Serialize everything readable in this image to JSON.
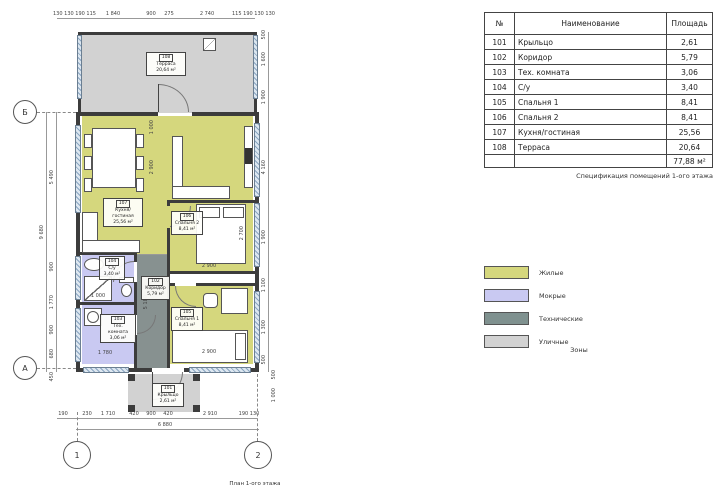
{
  "colors": {
    "living": "#d5d77d",
    "wet": "#c9c9f2",
    "technical": "#7f918f",
    "street": "#d2d2d2",
    "wall": "#3c3c3c"
  },
  "plan": {
    "caption": "План 1-ого этажа",
    "axes": {
      "b": "Б",
      "a": "А",
      "one": "1",
      "two": "2"
    },
    "rooms": {
      "porch": {
        "num": "101",
        "name": "Крыльцо",
        "area": "2,61 м²"
      },
      "corridor": {
        "num": "102",
        "name": "Коридор",
        "area": "5,79 м²"
      },
      "tech": {
        "num": "103",
        "name": "Тех. комната",
        "area": "3,06 м²"
      },
      "wc": {
        "num": "104",
        "name": "С/у",
        "area": "3,40 м²"
      },
      "bedroom1": {
        "num": "105",
        "name": "Спальня 1",
        "area": "8,41 м²"
      },
      "bedroom2": {
        "num": "106",
        "name": "Спальня 2",
        "area": "8,41 м²"
      },
      "kitchen": {
        "num": "107",
        "name": "Кухня/гостиная",
        "area": "25,56 м²"
      },
      "terrace": {
        "num": "108",
        "name": "Терраса",
        "area": "20,64 м²"
      }
    },
    "dims": {
      "top": [
        "130 130 190 115",
        "1 840",
        "900",
        "275",
        "2 740",
        "115 190 130 130"
      ],
      "left": {
        "total": "9 680",
        "chain": [
          "5 490",
          "900",
          "1 770",
          "900",
          "680"
        ],
        "below": "450"
      },
      "right": [
        "500",
        "1 600",
        "1 900",
        "4 160",
        "1 900",
        "1 100",
        "1 300",
        "500"
      ],
      "right_extra": [
        "500",
        "1 000"
      ],
      "bottom": [
        "190",
        "230",
        "1 710",
        "420",
        "900",
        "420",
        "2 910",
        "190 130"
      ],
      "bottom_total": "6 880",
      "interior": {
        "living_w": "1 000",
        "living_h": "2 900",
        "bed2_d": "2 700",
        "bed2_w": "2 900",
        "bed1_w": "2 900",
        "shower": "1 000",
        "tech_w": "1 780",
        "corridor_l": "5 180"
      }
    }
  },
  "table": {
    "headers": [
      "№",
      "Наименование",
      "Площадь"
    ],
    "rows": [
      [
        "101",
        "Крыльцо",
        "2,61"
      ],
      [
        "102",
        "Коридор",
        "5,79"
      ],
      [
        "103",
        "Тех. комната",
        "3,06"
      ],
      [
        "104",
        "С/у",
        "3,40"
      ],
      [
        "105",
        "Спальня 1",
        "8,41"
      ],
      [
        "106",
        "Спальня 2",
        "8,41"
      ],
      [
        "107",
        "Кухня/гостиная",
        "25,56"
      ],
      [
        "108",
        "Терраса",
        "20,64"
      ]
    ],
    "total": "77,88 м²",
    "caption": "Спецификация помещений 1-ого этажа"
  },
  "legend": {
    "title": "Зоны",
    "items": [
      {
        "label": "Жилые",
        "color": "#d5d77d"
      },
      {
        "label": "Мокрые",
        "color": "#c9c9f2"
      },
      {
        "label": "Технические",
        "color": "#7f918f"
      },
      {
        "label": "Уличные",
        "color": "#d2d2d2"
      }
    ]
  }
}
